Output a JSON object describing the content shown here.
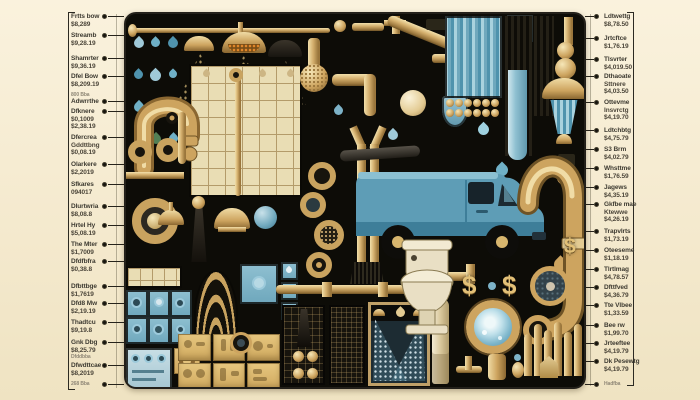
{
  "scene_title": "Plumbing services illustrated collage with price callouts",
  "colors": {
    "background": "#f4e9cd",
    "panel": "#0d0c07",
    "brass": "#c9a35f",
    "brass_light": "#f0dca6",
    "water_blue": "#8fc3d4",
    "van_teal": "#5e9db6",
    "tile_cream": "#e9ddb4",
    "text": "#3d3a31"
  },
  "illustration": {
    "dollar_sign": "$",
    "icons": [
      "shower-head-icon",
      "water-drop-icon",
      "faucet-icon",
      "pipe-icon",
      "tile-panel",
      "plumber-van",
      "toilet-icon",
      "dollar-sign",
      "drain-porthole",
      "radiator-icon",
      "spray-chamber",
      "valve-icon",
      "gauge-icon",
      "water-column",
      "control-panel"
    ]
  },
  "left_callouts": [
    {
      "lines": [
        "Frtts bow",
        "$8,289"
      ],
      "top": 13
    },
    {
      "lines": [
        "Streamb",
        "$9,28.19"
      ],
      "top": 32
    },
    {
      "lines": [
        "Shamrter",
        "$9,36.19"
      ],
      "top": 55
    },
    {
      "lines": [
        "Dfel Bow",
        "$8,209.19"
      ],
      "top": 73
    },
    {
      "lines": [
        "800 Bba"
      ],
      "top": 92,
      "small": true,
      "dot": false
    },
    {
      "lines": [
        "Adwrrthe"
      ],
      "top": 98
    },
    {
      "lines": [
        "Dfknere",
        "$0,1009",
        "$2,38.19"
      ],
      "top": 108
    },
    {
      "lines": [
        "Dfercrea",
        "Gddttbng",
        "$0,08.19"
      ],
      "top": 134
    },
    {
      "lines": [
        "Olarkere",
        "$2,2019"
      ],
      "top": 161
    },
    {
      "lines": [
        "Sfkares",
        "094017"
      ],
      "top": 181
    },
    {
      "lines": [
        "Dlurtwria",
        "$8,08.8"
      ],
      "top": 203
    },
    {
      "lines": [
        "Hrtel Hy",
        "$5,08.19"
      ],
      "top": 222
    },
    {
      "lines": [
        "The Mter",
        "$1,7009"
      ],
      "top": 241
    },
    {
      "lines": [
        "Dfdfbfra",
        "$0,38.8"
      ],
      "top": 258
    },
    {
      "lines": [
        "Dfbttbge",
        "$1,7619"
      ],
      "top": 283
    },
    {
      "lines": [
        "Dfd8 Mw",
        "$2,19.19"
      ],
      "top": 300
    },
    {
      "lines": [
        "Thadtcu",
        "$9,19.8"
      ],
      "top": 319
    },
    {
      "lines": [
        "Gnk Dbg",
        "$8,25.79"
      ],
      "top": 339
    },
    {
      "lines": [
        "Dfddbba"
      ],
      "top": 354,
      "small": true,
      "dot": false
    },
    {
      "lines": [
        "Dfwdttcae",
        "$8,2019"
      ],
      "top": 362
    },
    {
      "lines": [
        "268 Bba"
      ],
      "top": 381,
      "small": true
    }
  ],
  "right_callouts": [
    {
      "lines": [
        "Ldtwettg",
        "$8,78.50"
      ],
      "top": 13
    },
    {
      "lines": [
        "Jrtcftce",
        "$1,76.19"
      ],
      "top": 35
    },
    {
      "lines": [
        "Tlsvrter",
        "$4,019.50"
      ],
      "top": 56
    },
    {
      "lines": [
        "Dthaoate",
        "Sttnere",
        "$4,03.50"
      ],
      "top": 73
    },
    {
      "lines": [
        "Ottevme",
        "Insvrctg",
        "$4,19.70"
      ],
      "top": 99
    },
    {
      "lines": [
        "Ldtchbtg",
        "$4,75.79"
      ],
      "top": 127
    },
    {
      "lines": [
        "S3 Brm",
        "$4,02.79"
      ],
      "top": 146
    },
    {
      "lines": [
        "Whsttme",
        "$1,76.59"
      ],
      "top": 165
    },
    {
      "lines": [
        "Jagews",
        "$4,35.19"
      ],
      "top": 184
    },
    {
      "lines": [
        "Gkfbe mae",
        "Ktewwe",
        "$4,26.19"
      ],
      "top": 201
    },
    {
      "lines": [
        "Trapvlrts",
        "$1,73.19"
      ],
      "top": 228
    },
    {
      "lines": [
        "Oteeseme",
        "$1,18.19"
      ],
      "top": 247
    },
    {
      "lines": [
        "Tlrtlmag",
        "$4,78.57"
      ],
      "top": 266
    },
    {
      "lines": [
        "Dfttfved",
        "$4,36.79"
      ],
      "top": 284
    },
    {
      "lines": [
        "Tte Vlbee",
        "$1,33.59"
      ],
      "top": 302
    },
    {
      "lines": [
        "Bee rw",
        "$1,99.70"
      ],
      "top": 322
    },
    {
      "lines": [
        "Jrteeftee",
        "$4,19.79"
      ],
      "top": 340
    },
    {
      "lines": [
        "Dk Pesewtg",
        "$4,19.79"
      ],
      "top": 358
    },
    {
      "lines": [
        "Hadfba"
      ],
      "top": 381,
      "small": true
    }
  ]
}
